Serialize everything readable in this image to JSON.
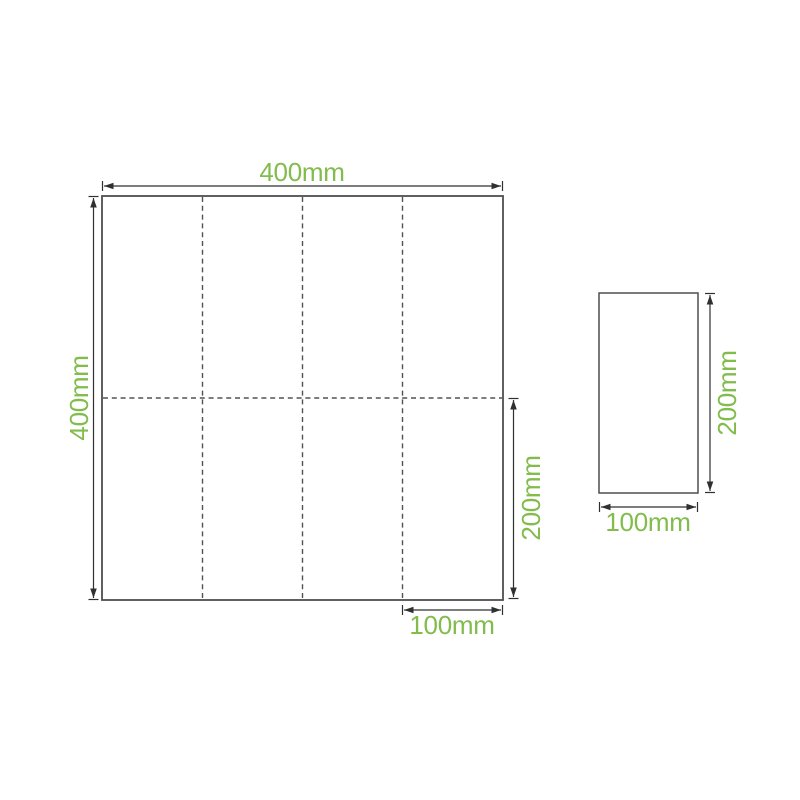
{
  "unfolded_sheet": {
    "width_label": "400mm",
    "height_label": "400mm",
    "half_height_label": "200mm",
    "panel_width_label": "100mm",
    "vertical_fold_lines": 3,
    "horizontal_fold_lines": 1
  },
  "folded_sheet": {
    "height_label": "200mm",
    "width_label": "100mm"
  },
  "colors": {
    "label_green": "#82BC4D",
    "outline_gray": "#4D4E50",
    "fold_line_gray": "#515254",
    "dimension_dark": "#2F3032"
  }
}
